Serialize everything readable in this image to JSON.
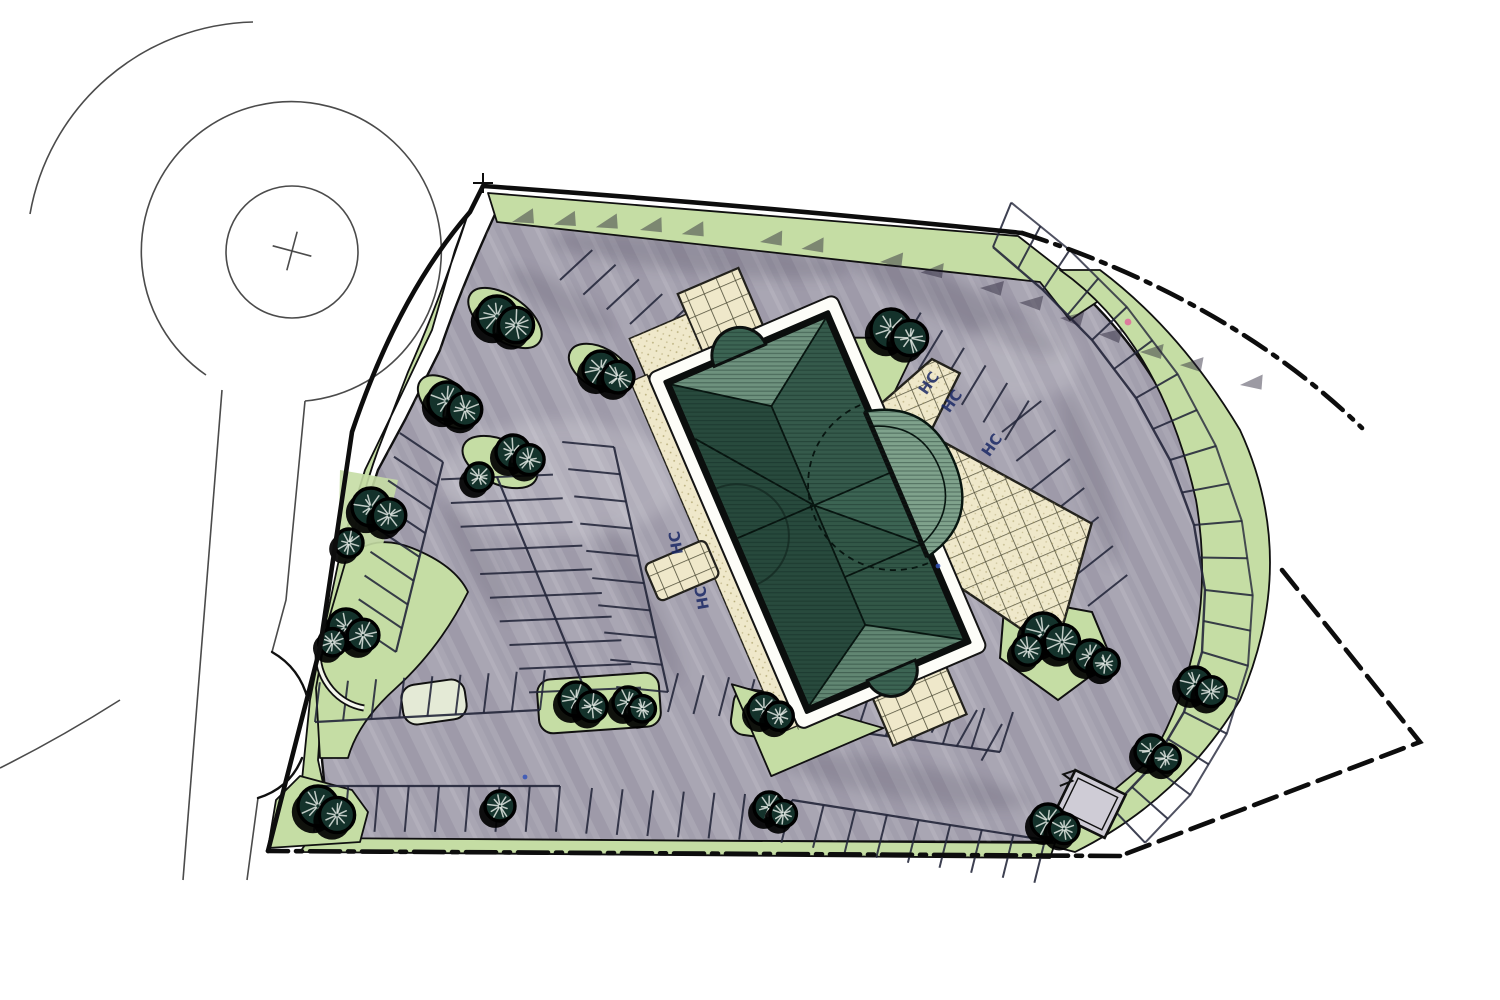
{
  "meta": {
    "kind": "hand-rendered architectural site plan",
    "sheet_background": "white"
  },
  "palette": {
    "paper": "#ffffff",
    "ink": "#141414",
    "road_line": "#4b4b4b",
    "asphalt": "#a9a6b3",
    "asphalt_light": "#cfccd6",
    "asphalt_streak": "#3a3650",
    "lawn": "#c5dda4",
    "lawn_dark": "#a6cb7f",
    "tree_fill": "#14322b",
    "tree_ink": "#000000",
    "tree_highlight": "#eef3ee",
    "roof_dark": "#27493c",
    "roof_mid": "#3c6453",
    "roof_light": "#7fa28c",
    "plaza": "#efe8ca",
    "plaza_line": "#45442f",
    "stipple": "#9b8f55",
    "stall_line": "#23263a",
    "curb": "#101010",
    "boundary": "#0d0d0d",
    "hc": "#1c2a66",
    "pink": "#e06a9e",
    "blue": "#3453b8",
    "shadow": "#241f33",
    "island_pale": "#e4ead6"
  },
  "annotations": {
    "handicap_label": "HC",
    "culdesac_cross": "+",
    "handicap_stalls": [
      {
        "x": 933,
        "y": 386,
        "rot": -55
      },
      {
        "x": 956,
        "y": 404,
        "rot": -55
      },
      {
        "x": 996,
        "y": 448,
        "rot": -55
      },
      {
        "x": 681,
        "y": 542,
        "rot": -100
      },
      {
        "x": 707,
        "y": 597,
        "rot": -100
      }
    ],
    "marks": [
      {
        "x": 1128,
        "y": 322,
        "color": "pink",
        "kind": "pen-tick"
      },
      {
        "x": 525,
        "y": 777,
        "color": "blue",
        "kind": "pen-dot"
      },
      {
        "x": 938,
        "y": 566,
        "color": "blue",
        "kind": "pen-dot"
      }
    ]
  },
  "trees": {
    "clusters": [
      {
        "x": 497,
        "y": 316,
        "r": 20,
        "n": 2
      },
      {
        "x": 447,
        "y": 401,
        "r": 19,
        "n": 2
      },
      {
        "x": 601,
        "y": 369,
        "r": 18,
        "n": 2
      },
      {
        "x": 513,
        "y": 452,
        "r": 17,
        "n": 2
      },
      {
        "x": 479,
        "y": 477,
        "r": 14,
        "n": 1
      },
      {
        "x": 371,
        "y": 507,
        "r": 19,
        "n": 2
      },
      {
        "x": 349,
        "y": 543,
        "r": 14,
        "n": 1
      },
      {
        "x": 346,
        "y": 627,
        "r": 18,
        "n": 3
      },
      {
        "x": 318,
        "y": 806,
        "r": 20,
        "n": 2
      },
      {
        "x": 500,
        "y": 806,
        "r": 15,
        "n": 1
      },
      {
        "x": 576,
        "y": 699,
        "r": 17,
        "n": 2
      },
      {
        "x": 628,
        "y": 702,
        "r": 15,
        "n": 2
      },
      {
        "x": 764,
        "y": 709,
        "r": 16,
        "n": 2
      },
      {
        "x": 769,
        "y": 807,
        "r": 15,
        "n": 2
      },
      {
        "x": 891,
        "y": 329,
        "r": 20,
        "n": 2
      },
      {
        "x": 1043,
        "y": 633,
        "r": 20,
        "n": 3
      },
      {
        "x": 1090,
        "y": 656,
        "r": 16,
        "n": 2
      },
      {
        "x": 1195,
        "y": 684,
        "r": 17,
        "n": 2
      },
      {
        "x": 1151,
        "y": 751,
        "r": 16,
        "n": 2
      },
      {
        "x": 1048,
        "y": 821,
        "r": 17,
        "n": 2
      }
    ]
  },
  "parking": {
    "rows": [
      {
        "p1": [
          560,
          280
        ],
        "p2": [
          700,
          368
        ],
        "len": 44,
        "n": 6,
        "side": -1,
        "tilt": 15,
        "spine": false
      },
      {
        "p1": [
          443,
          462
        ],
        "p2": [
          396,
          652
        ],
        "len": 52,
        "n": 8,
        "side": 1,
        "tilt": 20,
        "spine": true
      },
      {
        "p1": [
          497,
          477
        ],
        "p2": [
          585,
          690
        ],
        "len": 56,
        "n": 9,
        "side": 0,
        "tilt": 20,
        "spine": true
      },
      {
        "p1": [
          614,
          447
        ],
        "p2": [
          668,
          692
        ],
        "len": 52,
        "n": 9,
        "side": 1,
        "tilt": 18,
        "spine": true
      },
      {
        "p1": [
          315,
          722
        ],
        "p2": [
          540,
          710
        ],
        "len": 40,
        "n": 8,
        "side": -1,
        "tilt": 10,
        "spine": true
      },
      {
        "p1": [
          668,
          712
        ],
        "p2": [
          770,
          720
        ],
        "len": 40,
        "n": 4,
        "side": -1,
        "tilt": 10,
        "spine": false
      },
      {
        "p1": [
          800,
          724
        ],
        "p2": [
          1000,
          752
        ],
        "len": 42,
        "n": 7,
        "side": -1,
        "tilt": 10,
        "spine": true
      },
      {
        "p1": [
          318,
          786
        ],
        "p2": [
          560,
          786
        ],
        "len": 46,
        "n": 8,
        "side": 1,
        "tilt": 5,
        "spine": true
      },
      {
        "p1": [
          592,
          788
        ],
        "p2": [
          745,
          794
        ],
        "len": 46,
        "n": 5,
        "side": 1,
        "tilt": 5,
        "spine": false
      },
      {
        "p1": [
          792,
          800
        ],
        "p2": [
          1045,
          840
        ],
        "len": 44,
        "n": 8,
        "side": 1,
        "tilt": 5,
        "spine": true
      },
      {
        "p1": [
          1002,
          432
        ],
        "p2": [
          1088,
          606
        ],
        "len": 50,
        "n": 6,
        "side": -1,
        "tilt": -12,
        "spine": false
      },
      {
        "p1": [
          897,
          352
        ],
        "p2": [
          1005,
          440
        ],
        "len": 46,
        "n": 5,
        "side": -1,
        "tilt": -8,
        "spine": false
      },
      {
        "p1": [
          902,
          668
        ],
        "p2": [
          1002,
          724
        ],
        "len": 42,
        "n": 4,
        "side": 1,
        "tilt": 0,
        "spine": false
      }
    ],
    "arc_row": {
      "center": [
        868,
        552
      ],
      "depth": 48,
      "points": [
        [
          993,
          247
        ],
        [
          1043,
          290
        ],
        [
          1092,
          340
        ],
        [
          1136,
          398
        ],
        [
          1170,
          460
        ],
        [
          1194,
          525
        ],
        [
          1205,
          590
        ],
        [
          1202,
          652
        ],
        [
          1184,
          712
        ],
        [
          1152,
          766
        ],
        [
          1112,
          808
        ]
      ]
    },
    "sawtooth": [
      [
        512,
        222
      ],
      [
        640,
        230
      ],
      [
        760,
        242
      ],
      [
        880,
        262
      ],
      [
        980,
        288
      ],
      [
        1060,
        318
      ],
      [
        1140,
        352
      ],
      [
        1240,
        385
      ],
      [
        1320,
        402
      ]
    ]
  },
  "islands": [
    {
      "type": "ellipse",
      "x": 505,
      "y": 318,
      "rx": 42,
      "ry": 22,
      "rot": 35,
      "fill": "lawn"
    },
    {
      "type": "ellipse",
      "x": 600,
      "y": 368,
      "rx": 34,
      "ry": 20,
      "rot": 30,
      "fill": "lawn"
    },
    {
      "type": "ellipse",
      "x": 447,
      "y": 402,
      "rx": 34,
      "ry": 20,
      "rot": 40,
      "fill": "lawn"
    },
    {
      "type": "ellipse",
      "x": 500,
      "y": 462,
      "rx": 40,
      "ry": 22,
      "rot": 25,
      "fill": "lawn"
    },
    {
      "type": "rect",
      "x": 402,
      "y": 682,
      "w": 64,
      "h": 40,
      "rot": -8,
      "fill": "island_pale"
    },
    {
      "type": "rect",
      "x": 538,
      "y": 676,
      "w": 122,
      "h": 54,
      "rot": -4,
      "fill": "lawn"
    },
    {
      "type": "rect",
      "x": 732,
      "y": 692,
      "w": 70,
      "h": 46,
      "rot": 8,
      "fill": "lawn"
    },
    {
      "type": "poly",
      "pts": "1005,596 1092,612 1112,660 1058,700 1000,658",
      "fill": "lawn"
    }
  ]
}
